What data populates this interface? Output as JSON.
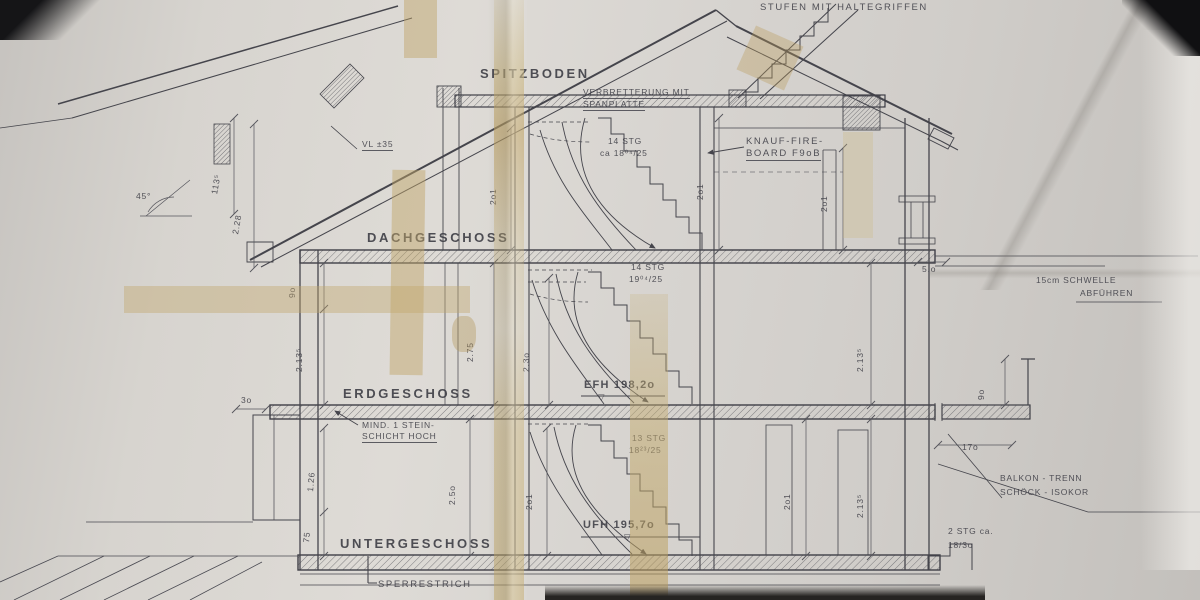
{
  "colors": {
    "paper": "#d6d3ce",
    "ink": "#45454c",
    "tape": "#c7ab6e",
    "photo_corner": "#141416"
  },
  "levels": {
    "spitzboden": "SPITZBODEN",
    "dachgeschoss": "DACHGESCHOSS",
    "erdgeschoss": "ERDGESCHOSS",
    "untergeschoss": "UNTERGESCHOSS"
  },
  "annotations": {
    "stufen": "STUFEN MIT HALTEGRIFFEN",
    "verbretterung_line1": "VERBRETTERUNG MIT",
    "verbretterung_line2": "SPANPLATTE",
    "vl": "VL ±35",
    "knauf_line1": "KNAUF-FIRE-",
    "knauf_line2": "BOARD F9oB",
    "stairs_top_line1": "14 STG",
    "stairs_top_line2": "ca 18⁰⁴/25",
    "stairs_mid_line1": "14 STG",
    "stairs_mid_line2": "19⁰⁴/25",
    "stairs_low_line1": "13 STG",
    "stairs_low_line2": "18²³/25",
    "stairs_out_line1": "2 STG ca.",
    "stairs_out_line2": "18/3o",
    "schwelle_line1": "15cm SCHWELLE",
    "schwelle_line2": "ABFÜHREN",
    "mind_line1": "MIND. 1 STEIN-",
    "mind_line2": "SCHICHT HOCH",
    "balkon_line1": "BALKON - TRENN",
    "balkon_line2": "SCHÖCK - ISOKOR",
    "sperrestrich": "SPERRESTRICH",
    "efh": "EFH 198,2o",
    "ufh": "UFH 195,7o",
    "level_marker": "▽"
  },
  "dimensions": {
    "d113": "113⁵",
    "d228": "2.28",
    "angle": "45°",
    "d90_left": "9o",
    "d2135_left": "2.13⁵",
    "d275": "2.75",
    "d230": "2.3o",
    "d250": "2.5o",
    "d126": "1.26",
    "d75": "75",
    "d30": "3o",
    "d201_a": "2o1",
    "d201_b": "2o1",
    "d201_c": "2o1",
    "d201_d": "2o1",
    "d201_e": "2o1",
    "d2135_right_up": "2.13⁵",
    "d2135_right_low": "2.13⁵",
    "d50": "5.o",
    "d90_right": "9o",
    "d170": "17o"
  }
}
